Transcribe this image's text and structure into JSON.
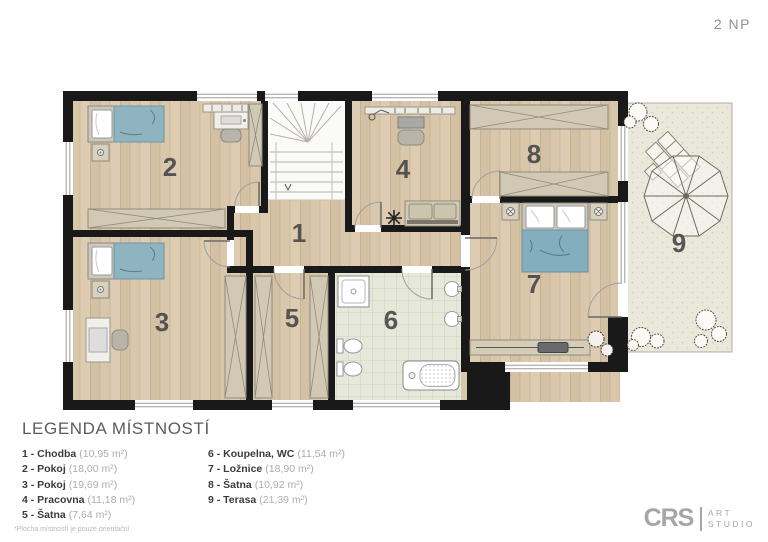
{
  "header": {
    "floor_label": "2 NP"
  },
  "plan": {
    "room_numbers": [
      "1",
      "2",
      "3",
      "4",
      "5",
      "6",
      "7",
      "8",
      "9"
    ]
  },
  "legend": {
    "title": "LEGENDA MÍSTNOSTÍ",
    "columns": [
      {
        "items": [
          {
            "label": "1 - Chodba",
            "area": "(10,95 m²)"
          },
          {
            "label": "2 - Pokoj",
            "area": "(18,00 m²)"
          },
          {
            "label": "3 - Pokoj",
            "area": "(19,69 m²)"
          },
          {
            "label": "4 - Pracovna",
            "area": "(11,18 m²)"
          },
          {
            "label": "5 - Šatna",
            "area": "(7,64 m²)"
          }
        ]
      },
      {
        "items": [
          {
            "label": "6 - Koupelna, WC",
            "area": "(11,54 m²)"
          },
          {
            "label": "7 - Ložnice",
            "area": "(18,90 m²)"
          },
          {
            "label": "8 - Šatna",
            "area": "(10,92 m²)"
          },
          {
            "label": "9 - Terasa",
            "area": "(21,39 m²)"
          }
        ]
      }
    ],
    "footnote": "*Plocha místností je pouze orientační"
  },
  "footer": {
    "logo_name": "CRS",
    "logo_sub1": "ART",
    "logo_sub2": "STUDIO"
  }
}
